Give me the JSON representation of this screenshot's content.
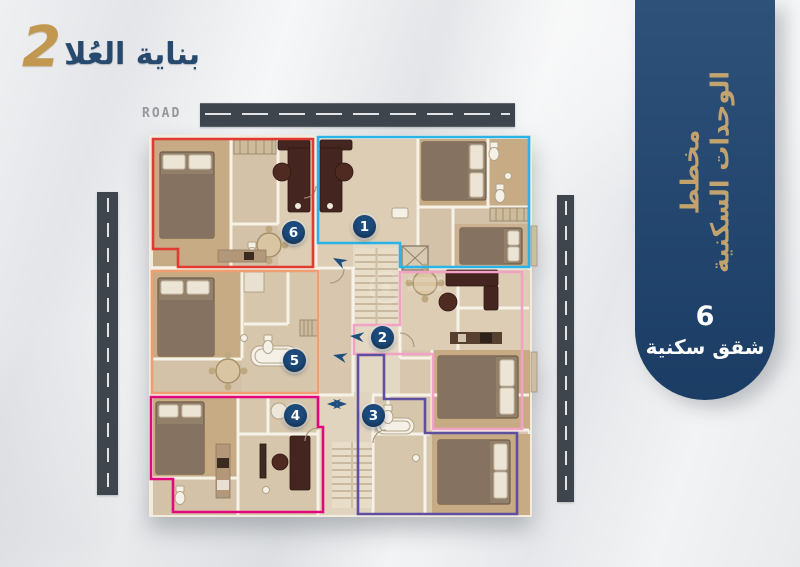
{
  "logo": {
    "name": "بناية العُلا",
    "edition": "2"
  },
  "top_road": {
    "label": "ROAD"
  },
  "sidebar": {
    "title_line1": "مخطط",
    "title_line2": "الوحدات السكنية",
    "apartment_count": "6",
    "apartment_count_label": "شقق سكنية"
  },
  "colors": {
    "logo_navy": "#26496d",
    "logo_gold": "#c2974f",
    "sidebar_navy": "#1e4470",
    "sidebar_gold": "#c2a36e",
    "road_asphalt": "#3e454d",
    "badge_navy": "#1c4a7b",
    "arrow_navy": "#1d4f7e"
  },
  "plan": {
    "units": [
      {
        "number": "1",
        "outline_color": "#29b3e6",
        "location": "top-right"
      },
      {
        "number": "2",
        "outline_color": "#f2a2c4",
        "location": "middle-right"
      },
      {
        "number": "3",
        "outline_color": "#5e4fa0",
        "location": "bottom-right"
      },
      {
        "number": "4",
        "outline_color": "#e3077e",
        "location": "bottom-left"
      },
      {
        "number": "5",
        "outline_color": "#ef9d72",
        "location": "middle-left"
      },
      {
        "number": "6",
        "outline_color": "#e03a33",
        "location": "top-left"
      }
    ]
  }
}
